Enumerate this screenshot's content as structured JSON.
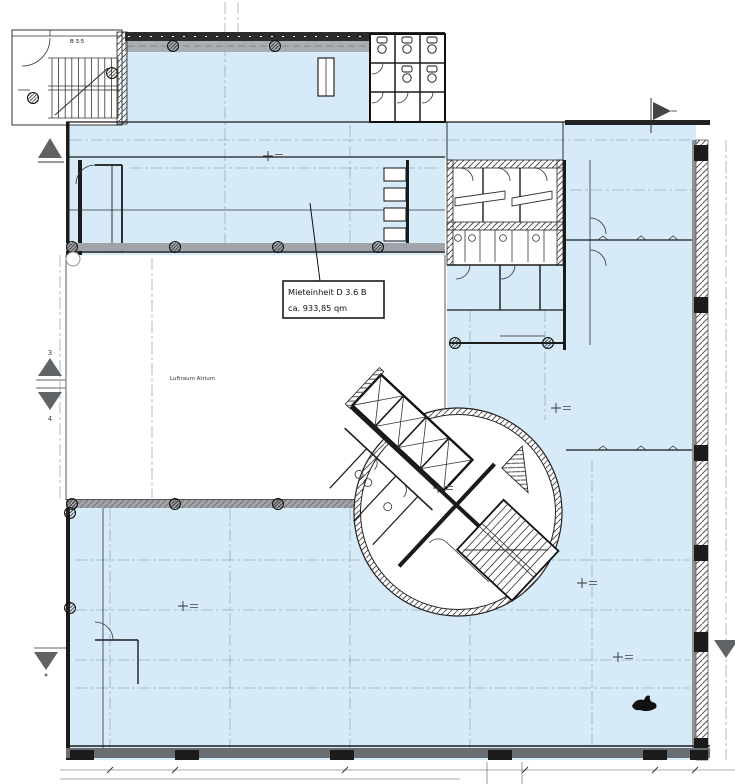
{
  "drawing": {
    "unit_label": {
      "line1": "Mieteinheit D 3.6 B",
      "line2": "ca. 933,85 qm"
    },
    "atrium_label": "Luftraum Atrium",
    "stairwell_label": "B 3.5",
    "section_markers": {
      "upper": "3",
      "lower": "4"
    }
  },
  "colors": {
    "floor_fill": "#d6ebf7",
    "wall_dark": "#1b1b1b",
    "band_gray": "#a0a4a8",
    "dark_band": "#6a6e72",
    "marker_gray": "#5f6366",
    "grid_blue": "#8fa5b5"
  }
}
